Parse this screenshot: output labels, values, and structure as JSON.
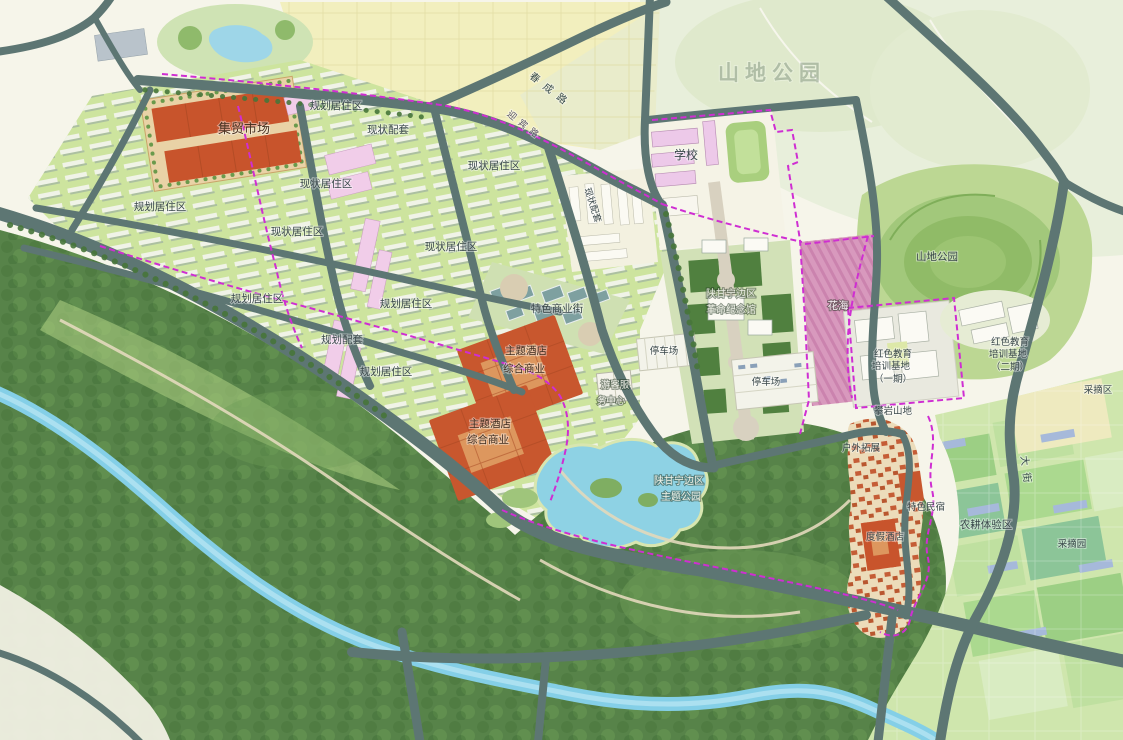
{
  "map": {
    "watermark": "山地公园",
    "palette": {
      "road": "#5d7673",
      "boundary_magenta": "#cf2ed2",
      "market_orange": "#c8542c",
      "water_blue": "#86cfe6",
      "residential_green": "#cde49e",
      "forest_green": "#578349",
      "field_yellow": "#f2efbe",
      "flower_pink": "#d899bd",
      "park_light": "#e8efdb",
      "farm_green": "#cfe6ad"
    },
    "labels": [
      {
        "text": "集贸市场",
        "x": 244,
        "y": 133,
        "fs": 13,
        "color": "#4a3322"
      },
      {
        "text": "规划居住区",
        "x": 336,
        "y": 109,
        "fs": 10.5
      },
      {
        "text": "现状配套",
        "x": 388,
        "y": 133,
        "fs": 10.5
      },
      {
        "text": "现状居住区",
        "x": 494,
        "y": 169,
        "fs": 10.5
      },
      {
        "text": "现状居住区",
        "x": 326,
        "y": 187,
        "fs": 10.5
      },
      {
        "text": "规划居住区",
        "x": 160,
        "y": 210,
        "fs": 10.5
      },
      {
        "text": "现状居住区",
        "x": 297,
        "y": 235,
        "fs": 10.5
      },
      {
        "text": "现状居住区",
        "x": 451,
        "y": 250,
        "fs": 10.5
      },
      {
        "text": "规划居住区",
        "x": 257,
        "y": 302,
        "fs": 10.5
      },
      {
        "text": "规划居住区",
        "x": 406,
        "y": 307,
        "fs": 10.5
      },
      {
        "text": "规划配套",
        "x": 342,
        "y": 343,
        "fs": 10.5
      },
      {
        "text": "规划居住区",
        "x": 386,
        "y": 375,
        "fs": 10.5
      },
      {
        "text": "现状配套",
        "x": 590,
        "y": 206,
        "fs": 9,
        "rot": 72
      },
      {
        "text": "学校",
        "x": 686,
        "y": 159,
        "fs": 12
      },
      {
        "text": "山地公园",
        "x": 772,
        "y": 80,
        "fs": 21,
        "color": "#8a9c88",
        "ls": 6,
        "op": 0.55,
        "bold": 1
      },
      {
        "text": "山地公园",
        "x": 937,
        "y": 260,
        "fs": 10.5
      },
      {
        "text": "花海",
        "x": 838,
        "y": 309,
        "fs": 10.5,
        "color": "#f6eef2",
        "hd": 1
      },
      {
        "text": "陕甘宁边区",
        "x": 731,
        "y": 297,
        "fs": 10,
        "color": "#eef0e6",
        "hd": 1
      },
      {
        "text": "革命纪念馆",
        "x": 731,
        "y": 313,
        "fs": 10,
        "color": "#eef0e6",
        "hd": 1
      },
      {
        "text": "停车场",
        "x": 664,
        "y": 354,
        "fs": 9.5
      },
      {
        "text": "停车场",
        "x": 766,
        "y": 385,
        "fs": 9.5
      },
      {
        "text": "游客服",
        "x": 615,
        "y": 388,
        "fs": 9.5,
        "color": "#f2f2ea",
        "hd": 1
      },
      {
        "text": "务中心",
        "x": 611,
        "y": 404,
        "fs": 9.5,
        "color": "#f2f2ea",
        "hd": 1
      },
      {
        "text": "特色商业街",
        "x": 557,
        "y": 312,
        "fs": 10.5
      },
      {
        "text": "主题酒店",
        "x": 526,
        "y": 354,
        "fs": 10.5,
        "color": "#3f2d1f"
      },
      {
        "text": "综合商业",
        "x": 524,
        "y": 372,
        "fs": 10.5,
        "color": "#3f2d1f"
      },
      {
        "text": "主题酒店",
        "x": 490,
        "y": 427,
        "fs": 10.5,
        "color": "#3f2d1f"
      },
      {
        "text": "综合商业",
        "x": 488,
        "y": 443,
        "fs": 10.5,
        "color": "#3f2d1f"
      },
      {
        "text": "陕甘宁边区",
        "x": 679,
        "y": 484,
        "fs": 10,
        "color": "#f2f4ea",
        "hd": 1
      },
      {
        "text": "主题公园",
        "x": 681,
        "y": 500,
        "fs": 10,
        "color": "#f2f4ea",
        "hd": 1
      },
      {
        "text": "红色教育",
        "x": 893,
        "y": 357,
        "fs": 9.5
      },
      {
        "text": "培训基地",
        "x": 891,
        "y": 369,
        "fs": 9.5
      },
      {
        "text": "（一期）",
        "x": 893,
        "y": 382,
        "fs": 9.5
      },
      {
        "text": "红色教育",
        "x": 1010,
        "y": 345,
        "fs": 9.5
      },
      {
        "text": "培训基地",
        "x": 1008,
        "y": 357,
        "fs": 9.5
      },
      {
        "text": "（二期）",
        "x": 1010,
        "y": 370,
        "fs": 9.5
      },
      {
        "text": "攀岩山地",
        "x": 893,
        "y": 414,
        "fs": 9.5
      },
      {
        "text": "户外拓展",
        "x": 861,
        "y": 451,
        "fs": 9.5
      },
      {
        "text": "特色民宿",
        "x": 926,
        "y": 510,
        "fs": 9.5
      },
      {
        "text": "度假酒店",
        "x": 885,
        "y": 540,
        "fs": 9.5
      },
      {
        "text": "农耕体验区",
        "x": 986,
        "y": 528,
        "fs": 10.5
      },
      {
        "text": "采摘园",
        "x": 1072,
        "y": 547,
        "fs": 9.5
      },
      {
        "text": "采摘区",
        "x": 1098,
        "y": 393,
        "fs": 9.5
      },
      {
        "text": "春成路",
        "x": 549,
        "y": 93,
        "fs": 10,
        "color": "#3a4d4d",
        "rot": 38,
        "ls": 7
      },
      {
        "text": "迎宾路",
        "x": 523,
        "y": 128,
        "fs": 9,
        "color": "#555066",
        "rot": 38,
        "ls": 5
      },
      {
        "text": "大街",
        "x": 1023,
        "y": 473,
        "fs": 10,
        "color": "#3a4d4d",
        "rot": 83,
        "ls": 7
      }
    ]
  }
}
